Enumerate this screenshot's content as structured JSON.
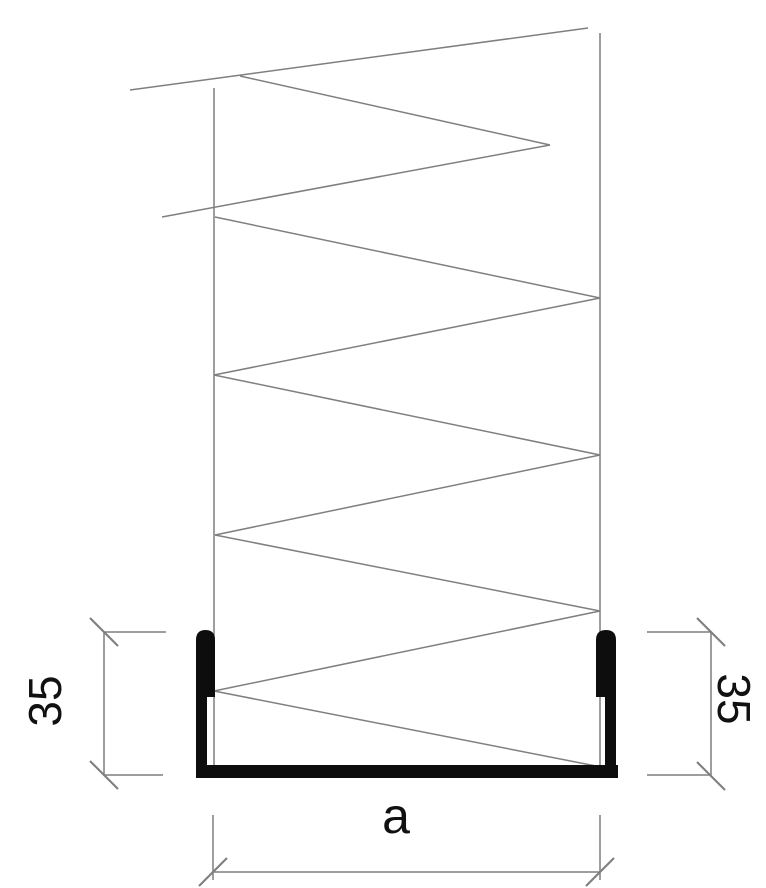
{
  "drawing": {
    "dimensions": {
      "left_height": "35",
      "right_height": "35",
      "bottom_width": "a"
    },
    "colors": {
      "background": "#ffffff",
      "line": "#7f7f7f",
      "profile": "#0d0d0d",
      "text": "#111111"
    }
  }
}
